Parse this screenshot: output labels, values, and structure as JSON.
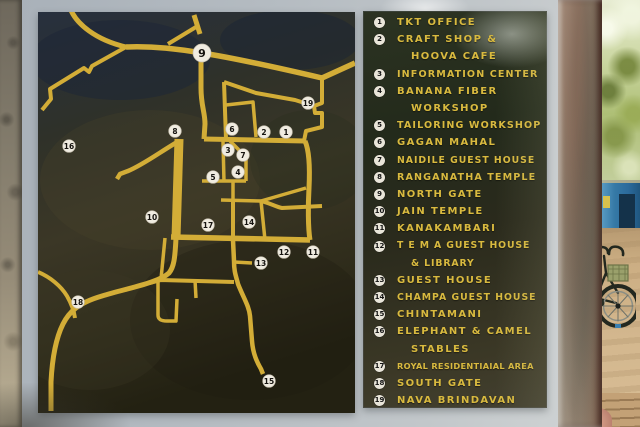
{
  "map": {
    "colors": {
      "road": "#d3ad37",
      "marker_bg": "#f0ece1",
      "marker_ring": "#c9c2b2",
      "marker_text": "#15130f",
      "panel_frame": "#a9b0b6"
    },
    "markers": [
      {
        "n": "1",
        "x": 286,
        "y": 132
      },
      {
        "n": "2",
        "x": 264,
        "y": 132
      },
      {
        "n": "3",
        "x": 228,
        "y": 150
      },
      {
        "n": "4",
        "x": 238,
        "y": 172
      },
      {
        "n": "5",
        "x": 213,
        "y": 177
      },
      {
        "n": "6",
        "x": 232,
        "y": 129
      },
      {
        "n": "7",
        "x": 243,
        "y": 155
      },
      {
        "n": "8",
        "x": 175,
        "y": 131
      },
      {
        "n": "9",
        "x": 202,
        "y": 53,
        "big": true
      },
      {
        "n": "10",
        "x": 152,
        "y": 217
      },
      {
        "n": "11",
        "x": 313,
        "y": 252
      },
      {
        "n": "12",
        "x": 284,
        "y": 252
      },
      {
        "n": "13",
        "x": 261,
        "y": 263
      },
      {
        "n": "14",
        "x": 249,
        "y": 222
      },
      {
        "n": "15",
        "x": 269,
        "y": 381
      },
      {
        "n": "16",
        "x": 69,
        "y": 146
      },
      {
        "n": "17",
        "x": 208,
        "y": 225
      },
      {
        "n": "18",
        "x": 78,
        "y": 302
      },
      {
        "n": "19",
        "x": 308,
        "y": 103
      }
    ],
    "roads": [
      {
        "d": "M70,8 C76,24 96,40 126,47",
        "w": 5
      },
      {
        "d": "M126,47 L92,66 L89,72 L84,68 L50,89 L51,99 L42,110",
        "w": 4
      },
      {
        "d": "M168,44 L196,27",
        "w": 4
      },
      {
        "d": "M194,15 L200,34",
        "w": 5
      },
      {
        "d": "M126,47 C155,46 178,49 202,53 C240,59 292,71 322,78 L355,63",
        "w": 5.5
      },
      {
        "d": "M322,78 L322,103 L314,106 L315,113 L322,113 L322,127 L306,131 L304,141",
        "w": 4
      },
      {
        "d": "M201,44 L201,88 C201,106 205,112 205,124 L204,139",
        "w": 5
      },
      {
        "d": "M224,82 L226,139",
        "w": 4
      },
      {
        "d": "M224,82 L256,93 L295,100 L314,106",
        "w": 4
      },
      {
        "d": "M226,105 L253,102 L256,137",
        "w": 3.5
      },
      {
        "d": "M204,139 L305,141",
        "w": 5
      },
      {
        "d": "M305,141 C309,150 310,168 309,188 C308,205 308,228 310,240",
        "w": 5
      },
      {
        "d": "M171,237 L310,240",
        "w": 5.5
      },
      {
        "d": "M179,139 L176,238",
        "w": 9
      },
      {
        "d": "M179,141 C163,150 143,165 128,171 L120,174 L117,179",
        "w": 4.5
      },
      {
        "d": "M223,141 L224,182",
        "w": 3.5
      },
      {
        "d": "M202,181 L246,181",
        "w": 3.5
      },
      {
        "d": "M230,141 L246,157 L246,181",
        "w": 3.5
      },
      {
        "d": "M233,181 L233,201",
        "w": 3.5
      },
      {
        "d": "M221,200 L261,201",
        "w": 3.5
      },
      {
        "d": "M261,201 L306,188",
        "w": 3.5
      },
      {
        "d": "M261,201 C270,203 276,207 282,208 L322,206",
        "w": 4
      },
      {
        "d": "M233,201 L233,240",
        "w": 4
      },
      {
        "d": "M261,201 L265,240",
        "w": 3.5
      },
      {
        "d": "M233,240 L234,261 C234,272 236,276 238,284 C244,299 249,306 250,316 L252,341 C253,354 257,362 261,369 L263,374",
        "w": 4.5
      },
      {
        "d": "M234,262 L252,263",
        "w": 3.5
      },
      {
        "d": "M165,238 L161,279",
        "w": 3.5
      },
      {
        "d": "M150,283 L161,280 L234,282",
        "w": 4
      },
      {
        "d": "M158,280 L158,315 C158,320 162,321 167,321 L176,321 L177,299",
        "w": 3.5
      },
      {
        "d": "M195,280 L196,298",
        "w": 3.5
      },
      {
        "d": "M176,238 C175,258 174,267 169,273 C158,283 128,288 102,296 C78,303 69,312 63,324 C55,340 52,362 51,382 L51,411",
        "w": 5
      },
      {
        "d": "M38,272 C50,277 61,286 67,296 C71,303 74,311 75,318",
        "w": 4
      }
    ]
  },
  "legend": {
    "colors": {
      "text": "#d9ba3f",
      "circle_bg": "#e9e5d9",
      "circle_text": "#141414"
    },
    "entries": [
      {
        "n": "1",
        "lines": [
          "TKT OFFICE"
        ]
      },
      {
        "n": "2",
        "lines": [
          "CRAFT SHOP &",
          "HOOVA CAFE"
        ]
      },
      {
        "n": "3",
        "lines": [
          "INFORMATION CENTER"
        ]
      },
      {
        "n": "4",
        "lines": [
          "BANANA FIBER",
          "WORKSHOP"
        ]
      },
      {
        "n": "5",
        "lines": [
          "TAILORING WORKSHOP"
        ]
      },
      {
        "n": "6",
        "lines": [
          "GAGAN MAHAL"
        ]
      },
      {
        "n": "7",
        "lines": [
          "NAIDILE GUEST HOUSE"
        ]
      },
      {
        "n": "8",
        "lines": [
          "RANGANATHA TEMPLE"
        ]
      },
      {
        "n": "9",
        "lines": [
          "NORTH GATE"
        ]
      },
      {
        "n": "10",
        "lines": [
          "JAIN TEMPLE"
        ]
      },
      {
        "n": "11",
        "lines": [
          "KANAKAMBARI"
        ]
      },
      {
        "n": "12",
        "lines": [
          "T E M A  GUEST  HOUSE",
          "& LIBRARY"
        ]
      },
      {
        "n": "13",
        "lines": [
          "GUEST HOUSE"
        ]
      },
      {
        "n": "14",
        "lines": [
          "CHAMPA GUEST HOUSE"
        ]
      },
      {
        "n": "15",
        "lines": [
          "CHINTAMANI"
        ]
      },
      {
        "n": "16",
        "lines": [
          "ELEPHANT & CAMEL",
          "STABLES"
        ]
      },
      {
        "n": "17",
        "lines": [
          "ROYAL RESIDENTIAIAL AREA"
        ]
      },
      {
        "n": "18",
        "lines": [
          "SOUTH GATE"
        ]
      },
      {
        "n": "19",
        "lines": [
          "NAVA BRINDAVAN"
        ]
      }
    ]
  },
  "scene": {
    "colors": {
      "wall_gray": "#b4bbc1",
      "stone_edge": "#94897a",
      "tree_trunk": "#cfc5b3",
      "foliage_green": "#8ba043",
      "shack_blue": "#3579a6",
      "ground_tan": "#c9aa7e",
      "bicycle_dark": "#252b21"
    }
  }
}
